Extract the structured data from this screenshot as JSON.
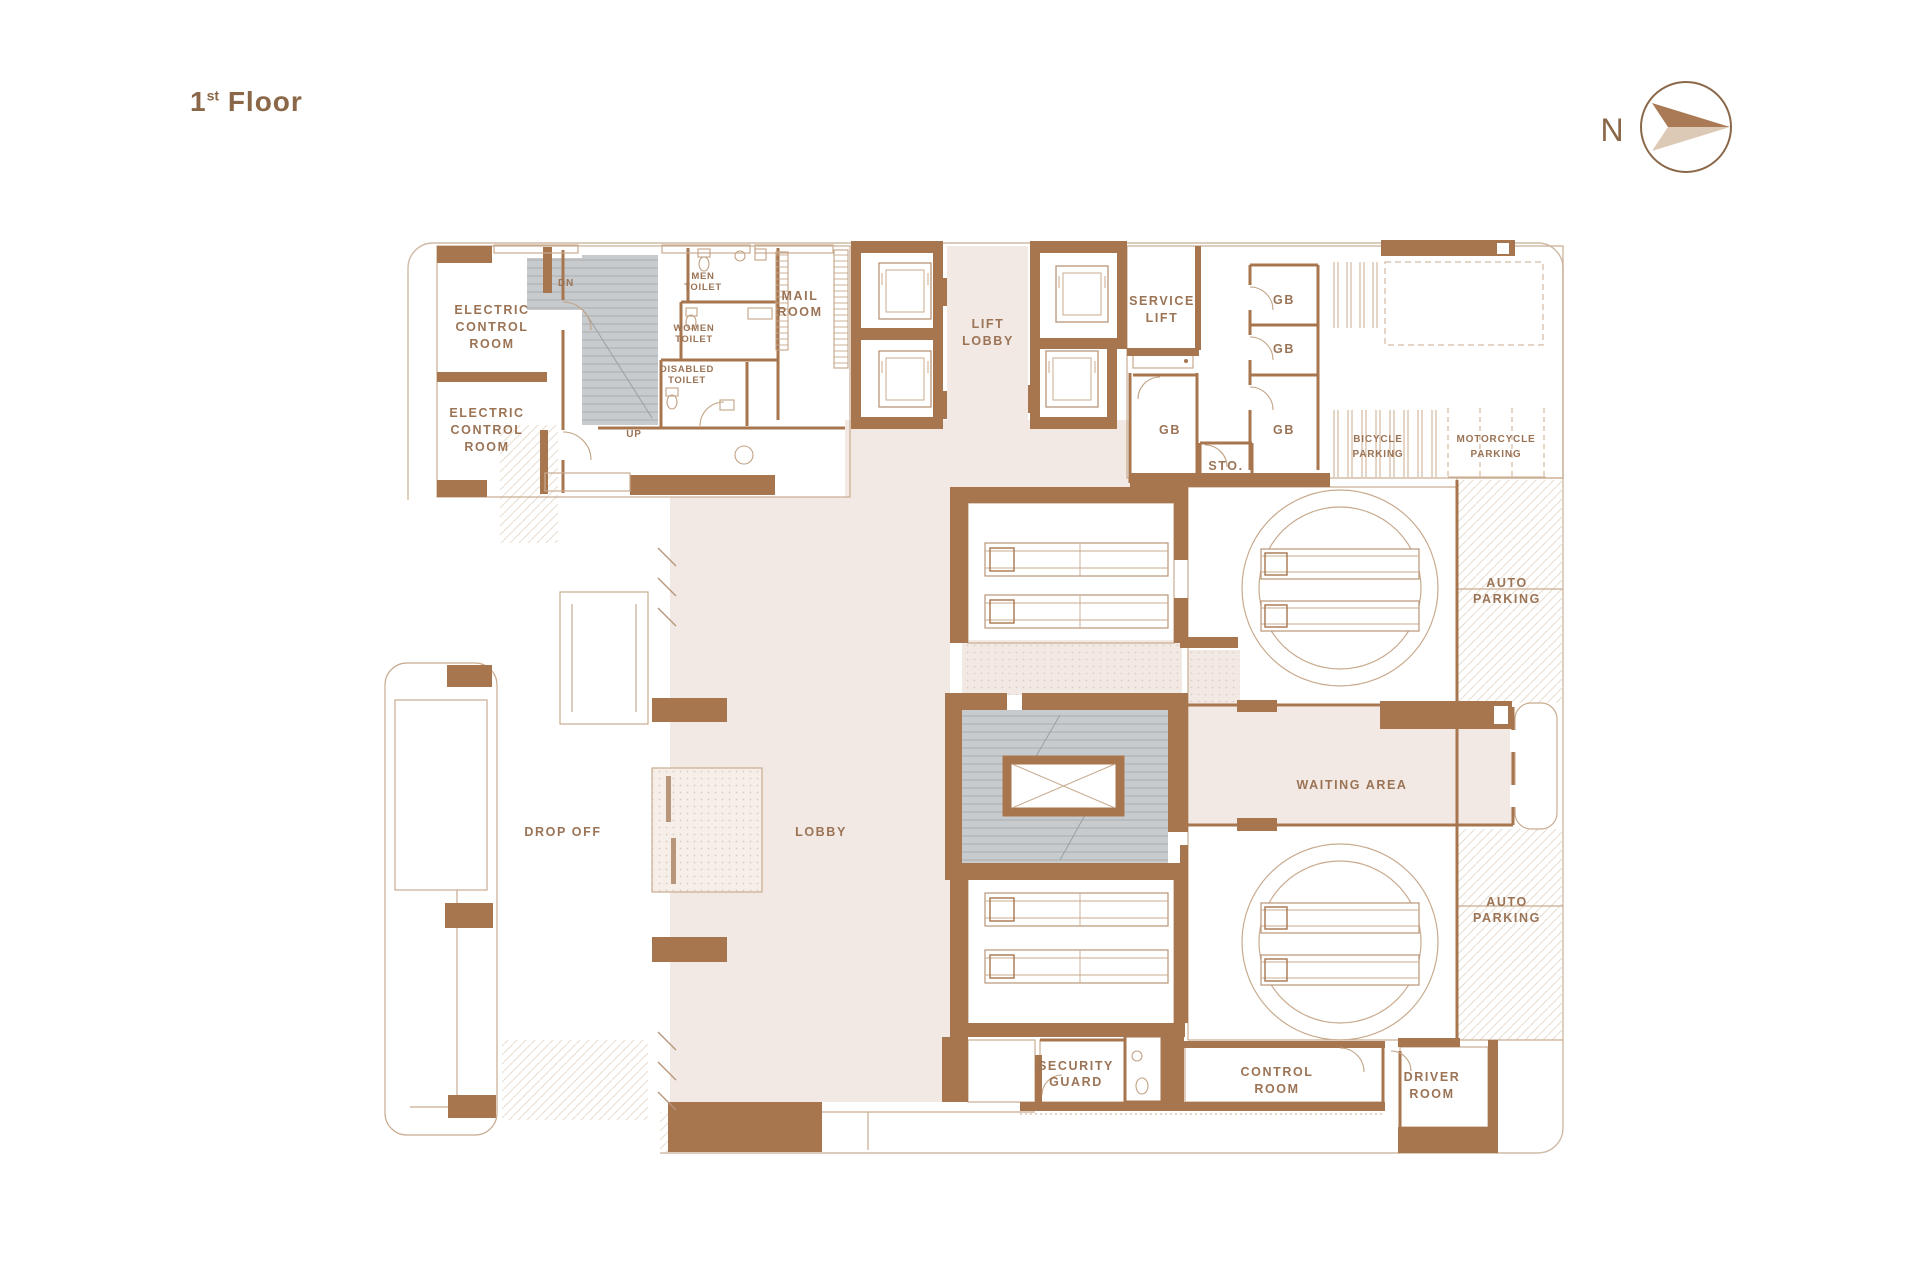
{
  "title": {
    "number": "1",
    "ordinal": "st",
    "word": "Floor"
  },
  "compass": {
    "label": "N"
  },
  "colors": {
    "wall": "#a7754e",
    "label_text": "#9b7355",
    "title_text": "#8a6748",
    "lobby_fill": "#f2e9e4",
    "stair_fill": "#c7cbcd",
    "outline": "#c9ab8f"
  },
  "labels": {
    "electric_control_1": [
      "ELECTRIC",
      "CONTROL",
      "ROOM"
    ],
    "electric_control_2": [
      "ELECTRIC",
      "CONTROL",
      "ROOM"
    ],
    "stairs": {
      "dn": "DN",
      "up": "UP"
    },
    "men_toilet": [
      "MEN",
      "TOILET"
    ],
    "women_toilet": [
      "WOMEN",
      "TOILET"
    ],
    "disabled_toilet": [
      "DISABLED",
      "TOILET"
    ],
    "mail_room": [
      "MAIL",
      "ROOM"
    ],
    "lift_lobby": [
      "LIFT",
      "LOBBY"
    ],
    "service_lift": [
      "SERVICE",
      "LIFT"
    ],
    "gb": "GB",
    "sto": "STO.",
    "bicycle_parking": [
      "BICYCLE",
      "PARKING"
    ],
    "motorcycle_parking": [
      "MOTORCYCLE",
      "PARKING"
    ],
    "auto_parking": [
      "AUTO",
      "PARKING"
    ],
    "waiting_area": "WAITING AREA",
    "drop_off": "DROP OFF",
    "lobby": "LOBBY",
    "security_guard": [
      "SECURITY",
      "GUARD"
    ],
    "control_room": [
      "CONTROL",
      "ROOM"
    ],
    "driver_room": [
      "DRIVER",
      "ROOM"
    ]
  }
}
